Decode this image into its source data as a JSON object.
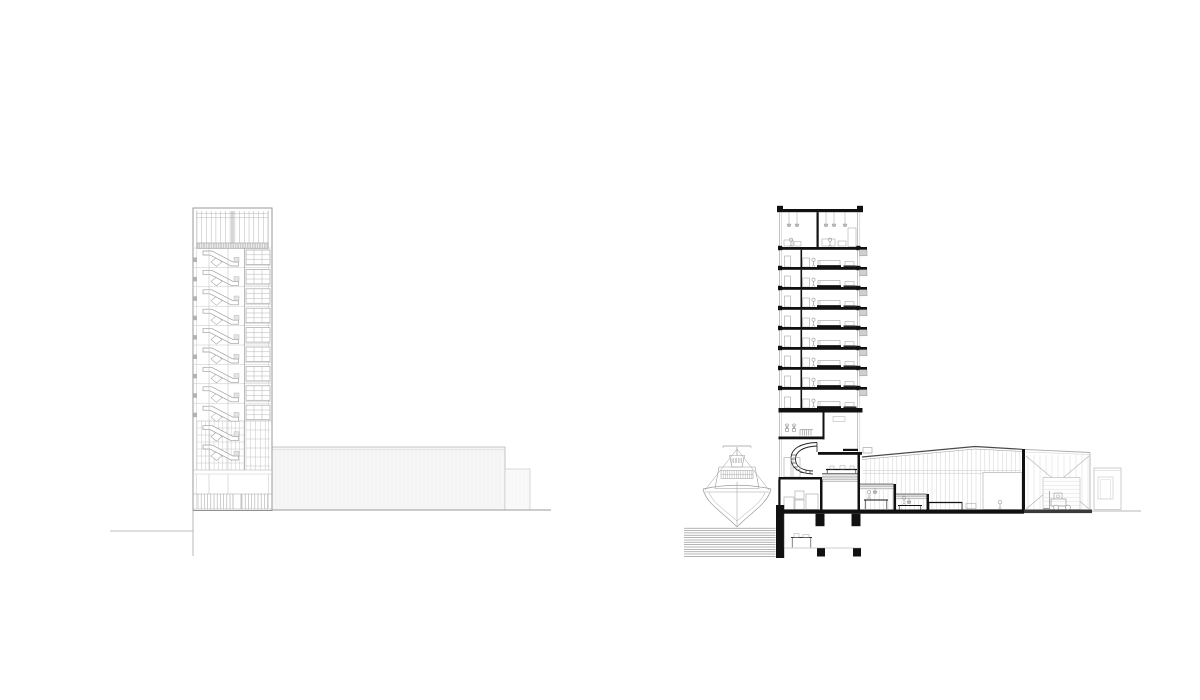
{
  "page": {
    "title": "Architectural drawings — tower elevation and cross-section",
    "background": "#ffffff"
  },
  "palette": {
    "elev_frame": "#9a9a9a",
    "elev_line": "#b5b5b5",
    "elev_faint": "#d2d2d2",
    "elev_fill": "#f6f6f6",
    "elev_ground": "#9a9a9a",
    "ink": "#111111",
    "mid_gray": "#8f8f8f",
    "sketch_gray": "#9b9b9b",
    "light_gray": "#c9c9c9",
    "faint_gray": "#dedede",
    "balcony_fill": "#cfcfcf",
    "hatch_gray": "#9c9c9c",
    "slab_dark": "#3a3a3a"
  },
  "elevation": {
    "name": "tower-elevation-with-shed",
    "typical_floors": 9,
    "stair_flights": 11,
    "window_grid": "3x3",
    "has_shed": true,
    "has_annex": true
  },
  "section": {
    "name": "tower-and-hall-cross-section",
    "typical_floors": 8,
    "balcony_count": 8,
    "double_height_top_floor": true,
    "stepped_levels": 4,
    "water_hatch_lines": 13,
    "elements": [
      "boat",
      "water",
      "quay-wall",
      "spiral-stair",
      "mezzanine",
      "stepped-study-rooms",
      "hall",
      "cross-braced-bay",
      "roller-door",
      "forklift",
      "annex-building",
      "basement-room",
      "foundation-piers"
    ]
  }
}
